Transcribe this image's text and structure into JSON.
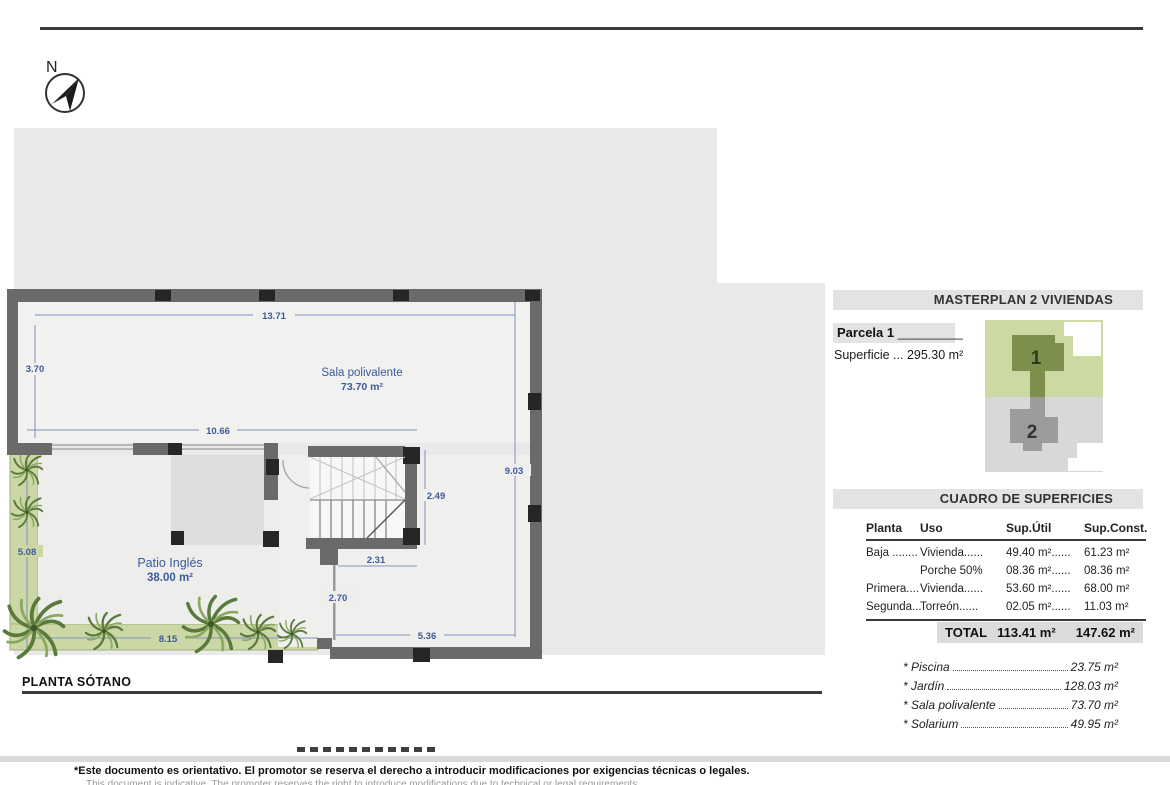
{
  "compass": {
    "label": "N"
  },
  "plan": {
    "title": "PLANTA SÓTANO",
    "rooms": {
      "sala": {
        "name": "Sala polivalente",
        "area": "73.70 m²"
      },
      "patio": {
        "name": "Patio Inglés",
        "area": "38.00 m²"
      }
    },
    "dimensions": {
      "top": "13.71",
      "upper_left": "3.70",
      "mid": "10.66",
      "right": "9.03",
      "lower_left": "5.08",
      "stair_v": "2.49",
      "stair_w": "2.31",
      "passage": "2.70",
      "bottom_left": "8.15",
      "bottom_right": "5.36"
    }
  },
  "masterplan": {
    "title": "MASTERPLAN 2 VIVIENDAS",
    "parcel_label": "Parcela 1",
    "parcel_line": "_________",
    "superficie": "Superficie ... 295.30 m²",
    "plot1": "1",
    "plot2": "2"
  },
  "surfaces": {
    "title": "CUADRO DE SUPERFICIES",
    "headers": [
      "Planta",
      "Uso",
      "Sup.Útil",
      "Sup.Const."
    ],
    "rows": [
      [
        "Baja ........",
        "Vivienda......",
        "49.40 m²......",
        "61.23 m²"
      ],
      [
        "",
        "Porche 50%",
        "08.36 m²......",
        "08.36 m²"
      ],
      [
        "Primera....",
        "Vivienda......",
        "53.60 m²......",
        "68.00 m²"
      ],
      [
        "Segunda...",
        "Torreón......",
        "02.05 m²......",
        "11.03 m²"
      ]
    ],
    "total_label": "TOTAL",
    "total_util": "113.41 m²",
    "total_const": "147.62 m²"
  },
  "extras": {
    "items": [
      {
        "label": "* Piscina",
        "value": "23.75 m²"
      },
      {
        "label": "* Jardín",
        "value": "128.03 m²"
      },
      {
        "label": "* Sala polivalente",
        "value": "73.70 m²"
      },
      {
        "label": "* Solarium",
        "value": "49.95 m²"
      }
    ]
  },
  "footer": {
    "line1": "*Este documento es orientativo. El promotor se reserva el derecho a introducir modificaciones por exigencias técnicas o legales.",
    "line2": "This document is indicative. The promoter reserves the right to introduce modifications due to technical or legal requirements."
  },
  "colors": {
    "dimension_blue": "#3d5a9b",
    "parcel_green": "#cdd9a2",
    "building_green": "#7d8f4d",
    "parcel_gray": "#d8d8d8",
    "building_gray": "#9c9c9c",
    "band_gray": "#e3e3e3"
  }
}
